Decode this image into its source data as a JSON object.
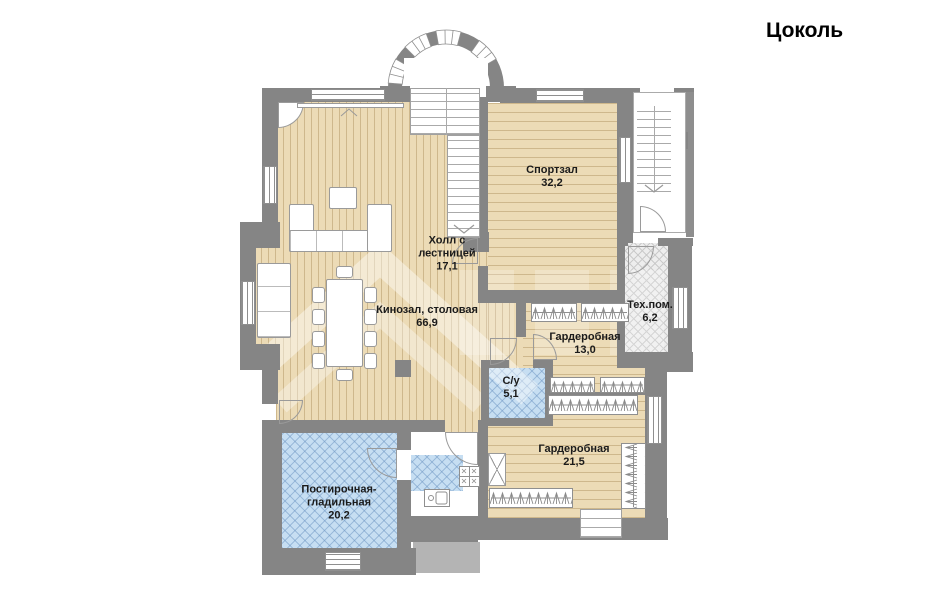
{
  "title": "Цоколь",
  "floor_name": "Цоколь",
  "rooms": {
    "gym": {
      "label": "Спортзал",
      "area": "32,2"
    },
    "hall": {
      "label": "Холл с лестницей",
      "area": "17,1"
    },
    "cinema": {
      "label": "Кинозал, столовая",
      "area": "66,9"
    },
    "tech": {
      "label": "Тех.пом.",
      "area": "6,2"
    },
    "wardrobe13": {
      "label": "Гардеробная",
      "area": "13,0"
    },
    "bathroom": {
      "label": "С/у",
      "area": "5,1"
    },
    "wardrobe21": {
      "label": "Гардеробная",
      "area": "21,5"
    },
    "laundry": {
      "label": "Постирочная-гладильная",
      "area": "20,2"
    }
  },
  "colors": {
    "wall": "#858585",
    "wood_floor": "#ecdbb6",
    "blue_floor": "#c6def2",
    "tech_floor": "#ededed",
    "accent_text": "#1b1b1b"
  }
}
